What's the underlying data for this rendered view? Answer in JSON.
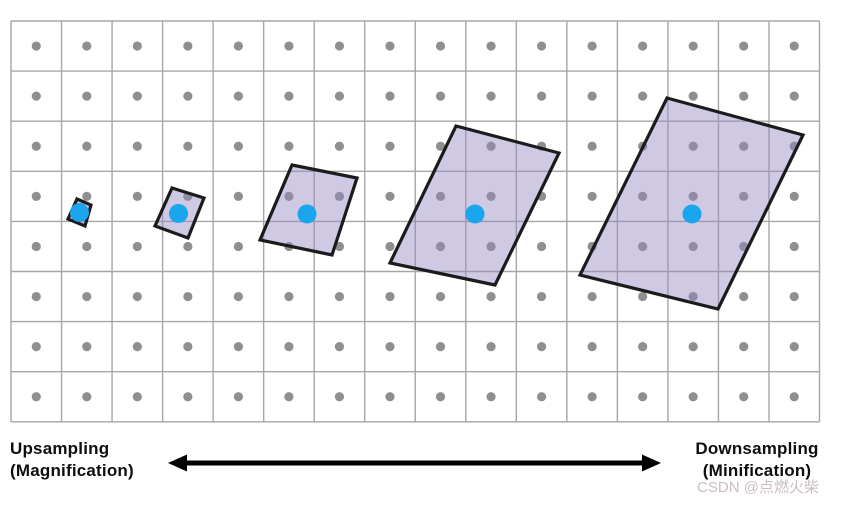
{
  "title": "Texture sampling footprints across pixel scales",
  "colors": {
    "background": "#ffffff",
    "grid_line": "#a6a6a6",
    "texel_dot": "#8f8f8f",
    "sample_dot": "#1aa5ec",
    "footprint_fill_rgba": "rgba(148,135,195,0.45)",
    "footprint_stroke": "#1b1b1d",
    "arrow": "#000000",
    "label_text": "#0e0e0e",
    "watermark_text": "#cbbdc1"
  },
  "grid": {
    "left": 11,
    "top": 21,
    "right": 819.5,
    "bottom": 421.8,
    "cols": 16,
    "rows": 8,
    "line_width": 1.4
  },
  "texel_dot_radius": 4.6,
  "sample_point_radius": 9.5,
  "sample_points": [
    {
      "x": 79.5,
      "y": 212.5
    },
    {
      "x": 178.5,
      "y": 213.5
    },
    {
      "x": 307,
      "y": 214
    },
    {
      "x": 475,
      "y": 214
    },
    {
      "x": 692,
      "y": 214
    }
  ],
  "footprints": [
    {
      "points": [
        [
          77,
          199
        ],
        [
          91,
          205
        ],
        [
          85,
          226
        ],
        [
          68,
          219
        ]
      ]
    },
    {
      "points": [
        [
          172,
          188
        ],
        [
          204,
          198
        ],
        [
          188,
          238
        ],
        [
          155,
          226
        ]
      ]
    },
    {
      "points": [
        [
          292,
          165
        ],
        [
          357,
          178
        ],
        [
          332,
          255
        ],
        [
          260,
          240
        ]
      ]
    },
    {
      "points": [
        [
          456,
          126
        ],
        [
          559,
          153
        ],
        [
          495,
          285
        ],
        [
          390,
          263
        ]
      ]
    },
    {
      "points": [
        [
          667,
          98
        ],
        [
          803,
          135
        ],
        [
          718,
          309
        ],
        [
          580,
          275
        ]
      ]
    }
  ],
  "footprint_stroke_width": 3.2,
  "arrow": {
    "y": 463,
    "x_left": 168,
    "x_right": 661,
    "thickness": 5,
    "head_length": 19,
    "head_width": 17
  },
  "labels": {
    "left_line1": "Upsampling",
    "left_line2": "(Magnification)",
    "right_line1": "Downsampling",
    "right_line2": "(Minification)",
    "watermark": "CSDN @点燃火柴"
  }
}
